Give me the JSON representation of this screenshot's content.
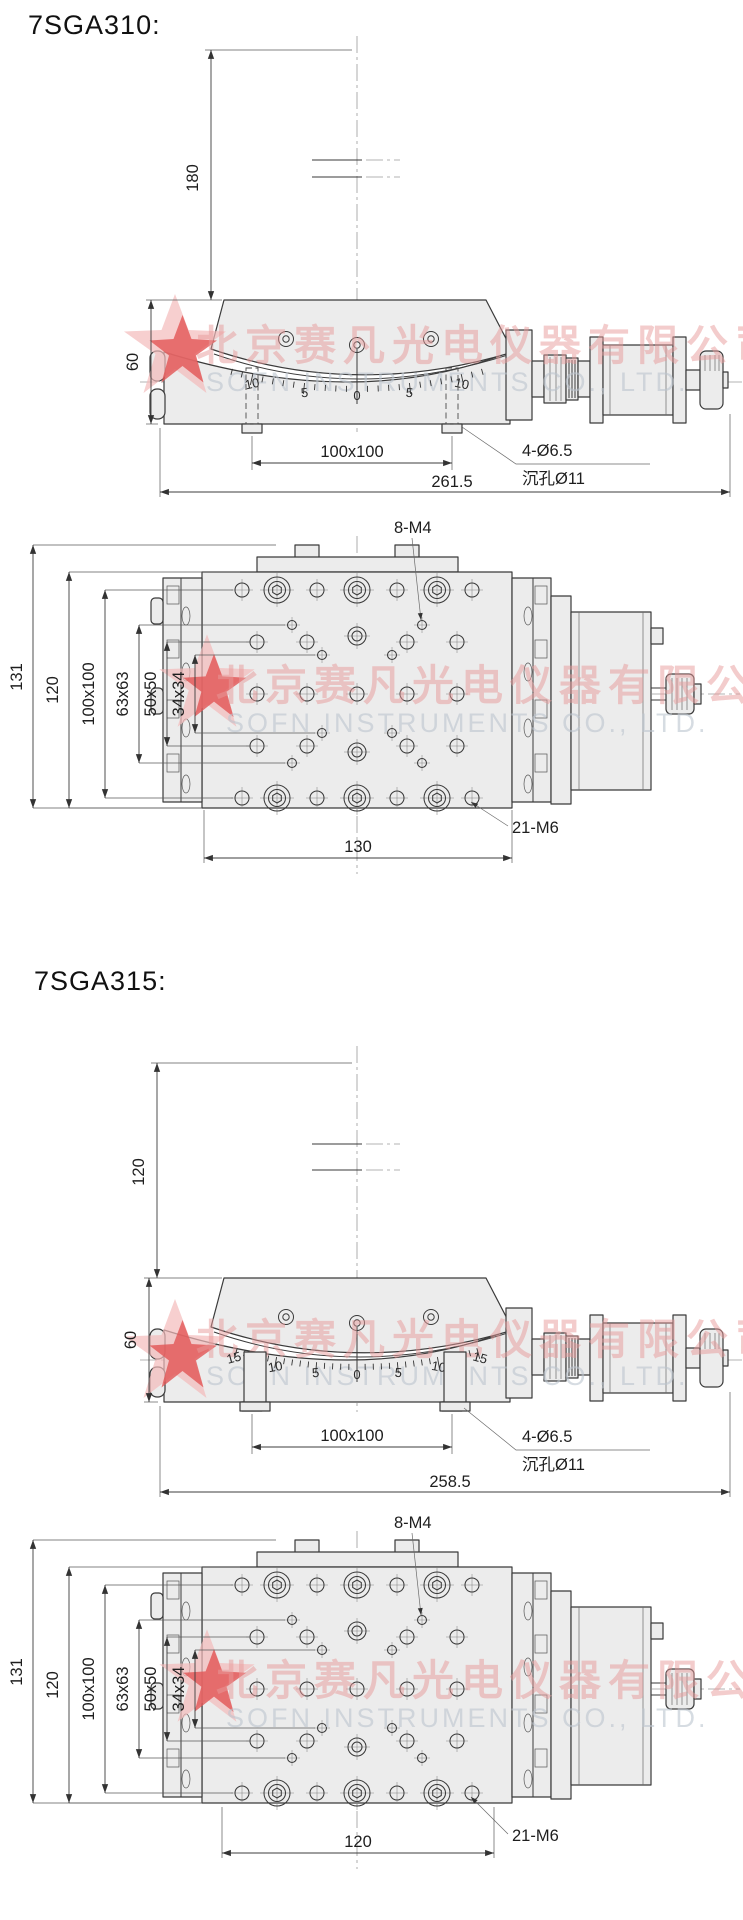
{
  "products": [
    {
      "title": "7SGA310:",
      "front": {
        "height_to_rotation_center": "180",
        "stage_height": "60",
        "mount_hole_spacing": "100x100",
        "total_length": "261.5",
        "mount_hole_note_line1": "4-Ø6.5",
        "mount_hole_note_line2": "沉孔Ø11",
        "scale_labels": [
          "10",
          "5",
          "0",
          "5",
          "10"
        ]
      },
      "top": {
        "top_hole_note": "8-M4",
        "plate_hole_note": "21-M6",
        "overall_depth": "131",
        "platform_depth": "120",
        "grid_100": "100x100",
        "grid_63": "63x63",
        "grid_50": "50x50",
        "grid_34": "34x34",
        "base_width": "130"
      }
    },
    {
      "title": "7SGA315:",
      "front": {
        "height_to_rotation_center": "120",
        "stage_height": "60",
        "mount_hole_spacing": "100x100",
        "total_length": "258.5",
        "mount_hole_note_line1": "4-Ø6.5",
        "mount_hole_note_line2": "沉孔Ø11",
        "scale_labels": [
          "15",
          "10",
          "5",
          "0",
          "5",
          "10",
          "15"
        ]
      },
      "top": {
        "top_hole_note": "8-M4",
        "plate_hole_note": "21-M6",
        "overall_depth": "131",
        "platform_depth": "120",
        "grid_100": "100x100",
        "grid_63": "63x63",
        "grid_50": "50x50",
        "grid_34": "34x34",
        "base_width": "120"
      }
    }
  ],
  "watermark": {
    "cn": "北京赛凡光电仪器有限公司",
    "en": "SOFN INSTRUMENTS CO., LTD."
  },
  "colors": {
    "line": "#3a3a3a",
    "metal_fill": "#ececec",
    "watermark_red": "#e89a9a",
    "watermark_gray": "#bcc5cf",
    "star_red": "#e25555",
    "star_pink": "#f3baba"
  }
}
